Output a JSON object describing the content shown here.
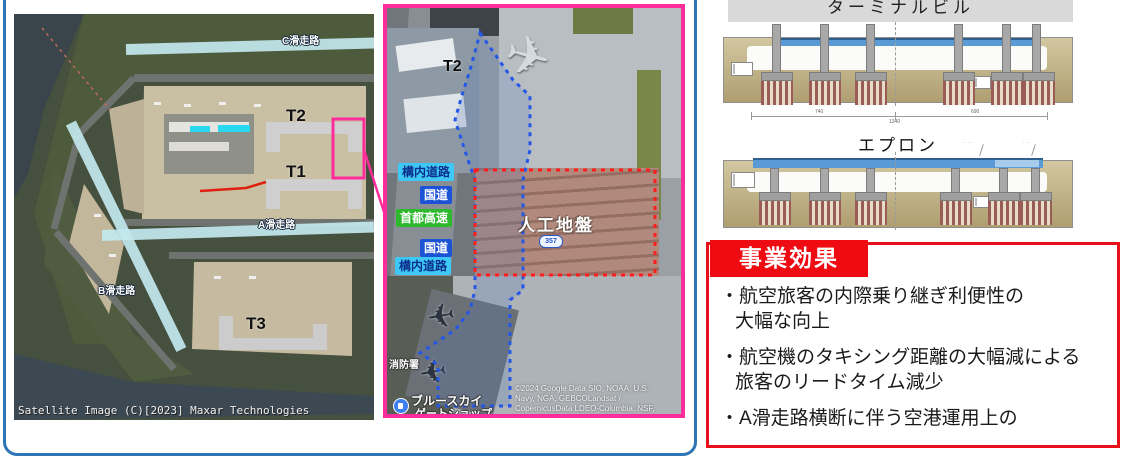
{
  "left_map": {
    "runway_c": "C滑走路",
    "runway_a": "A滑走路",
    "runway_b": "B滑走路",
    "terminal_1": "T1",
    "terminal_2": "T2",
    "terminal_3": "T3",
    "attribution": "Satellite Image (C)[2023] Maxar Technologies"
  },
  "detail_map": {
    "terminal_2": "T2",
    "road_labels": [
      {
        "text": "構内道路",
        "style": "campus"
      },
      {
        "text": "国道",
        "style": "national"
      },
      {
        "text": "首都高速",
        "style": "expressway"
      },
      {
        "text": "国道",
        "style": "national"
      },
      {
        "text": "構内道路",
        "style": "campus"
      }
    ],
    "artificial_ground_label": "人工地盤",
    "route_shield": "357",
    "poi_fire_station": "消防署",
    "poi_shop_line1": "ブルースカイ",
    "poi_shop_line2": "ゲートショップ",
    "attribution_line1": "©2024 Google Data SIO, NOAA, U.S.",
    "attribution_line2": "Navy, NGA, GEBCOLandsat /",
    "attribution_line3": "CopernicusData LDEO-Columbia, NSF,"
  },
  "cross_sections": {
    "terminal_title": "ターミナルビル",
    "apron_title": "エプロン",
    "dim_left": "740",
    "dim_center": "1340",
    "dim_right": "690"
  },
  "effects": {
    "title": "事業効果",
    "bullets": [
      {
        "line1": "・航空旅客の内際乗り継ぎ利便性の",
        "line2": "大幅な向上"
      },
      {
        "line1": "・航空機のタキシング距離の大幅減による",
        "line2": "旅客のリードタイム減少"
      },
      {
        "line1": "・A滑走路横断に伴う空港運用上の",
        "line2": ""
      }
    ]
  },
  "colors": {
    "frame_blue": "#2E75B6",
    "highlight_pink": "#FF2D9B",
    "effects_red": "#EE0C12",
    "road_national_bg": "#1C53D6",
    "road_expressway_bg": "#2EB82E",
    "road_campus_bg": "#3EC8F5",
    "deck_blue": "#5B9BD5",
    "dotted_blue": "#2457E6",
    "dotted_red": "#FF1E1E"
  }
}
